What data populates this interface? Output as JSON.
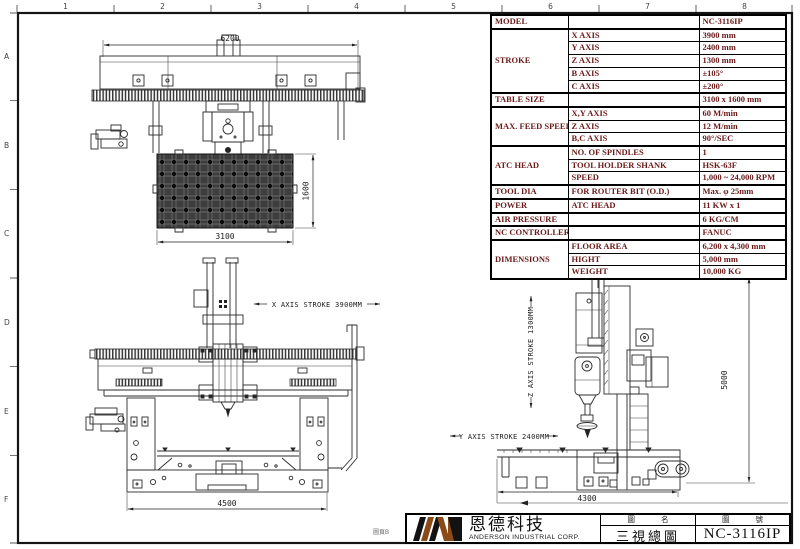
{
  "border": {
    "cols": [
      "1",
      "2",
      "3",
      "4",
      "5",
      "6",
      "7",
      "8"
    ],
    "rows": [
      "A",
      "B",
      "C",
      "D",
      "E",
      "F"
    ],
    "page_label": "圖頁B"
  },
  "spec_table": {
    "text_color": "#6b1a1a",
    "groups": [
      {
        "label": "MODEL",
        "rows": [
          {
            "sub": "",
            "value": "NC-3116IP"
          }
        ]
      },
      {
        "label": "STROKE",
        "rows": [
          {
            "sub": "X AXIS",
            "value": "3900 mm"
          },
          {
            "sub": "Y AXIS",
            "value": "2400 mm"
          },
          {
            "sub": "Z AXIS",
            "value": "1300 mm"
          },
          {
            "sub": "B AXIS",
            "value": "±105°"
          },
          {
            "sub": "C AXIS",
            "value": "±200°"
          }
        ]
      },
      {
        "label": "TABLE SIZE",
        "rows": [
          {
            "sub": "",
            "value": "3100 x 1600 mm"
          }
        ]
      },
      {
        "label": "MAX. FEED SPEED",
        "rows": [
          {
            "sub": "X,Y AXIS",
            "value": "60 M/min"
          },
          {
            "sub": "Z AXIS",
            "value": "12 M/min"
          },
          {
            "sub": "B,C AXIS",
            "value": "90°/SEC"
          }
        ]
      },
      {
        "label": "ATC HEAD",
        "rows": [
          {
            "sub": "NO. OF SPINDLES",
            "value": "1"
          },
          {
            "sub": "TOOL HOLDER SHANK",
            "value": "HSK-63F"
          },
          {
            "sub": "SPEED",
            "value": "1,000 ~ 24,000 RPM"
          }
        ]
      },
      {
        "label": "TOOL DIA",
        "rows": [
          {
            "sub": "FOR ROUTER BIT (O.D.)",
            "value": "Max.  φ 25mm"
          }
        ]
      },
      {
        "label": "POWER",
        "rows": [
          {
            "sub": "ATC HEAD",
            "value": "11 KW x 1"
          }
        ]
      },
      {
        "label": "AIR PRESSURE",
        "rows": [
          {
            "sub": "",
            "value": "6 KG/CM"
          }
        ]
      },
      {
        "label": "NC CONTROLLER",
        "rows": [
          {
            "sub": "",
            "value": "FANUC"
          }
        ]
      },
      {
        "label": "DIMENSIONS",
        "rows": [
          {
            "sub": "FLOOR AREA",
            "value": "6,200 x 4,300 mm"
          },
          {
            "sub": "HIGHT",
            "value": "5,000 mm"
          },
          {
            "sub": "WEIGHT",
            "value": "10,000 KG"
          }
        ]
      }
    ]
  },
  "drawings": {
    "plan": {
      "dim_width": "6200",
      "dim_table_w": "3100",
      "dim_table_h": "1600"
    },
    "front": {
      "stroke_label": "X AXIS STROKE 3900MM",
      "dim_base": "4500"
    },
    "side": {
      "z_stroke_label": "Z AXIS STROKE 1300MM",
      "y_stroke_label": "Y AXIS STROKE 2400MM",
      "dim_height": "5000",
      "dim_base": "4300"
    }
  },
  "title_block": {
    "company_cn": "恩德科技",
    "company_en": "ANDERSON INDUSTRIAL CORP.",
    "name_header": "圖 名",
    "name_value": "三視總圖",
    "no_header": "圖 號",
    "no_value": "NC-3116IP",
    "logo_black": "#121212",
    "logo_brown": "#8a4a17"
  }
}
